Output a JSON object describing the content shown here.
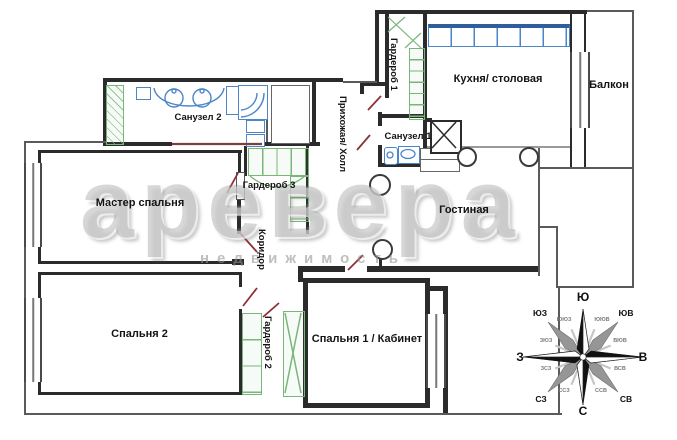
{
  "rooms": {
    "sanuzel2": {
      "label": "Санузел 2"
    },
    "garderob3": {
      "label": "Гардероб 3"
    },
    "master": {
      "label": "Мастер спальня"
    },
    "bedroom2": {
      "label": "Спальня 2"
    },
    "garderob2": {
      "label": "Гардероб 2"
    },
    "bedroom1": {
      "label": "Спальня 1 / Кабинет"
    },
    "corridor": {
      "label": "Коридор"
    },
    "hall": {
      "label": "Прихожая/ Холл"
    },
    "garderob1": {
      "label": "Гардероб 1"
    },
    "kitchen": {
      "label": "Кухня/ столовая"
    },
    "balcony": {
      "label": "Балкон"
    },
    "sanuzel1": {
      "label": "Санузел 1"
    },
    "living": {
      "label": "Гостиная"
    }
  },
  "watermark": {
    "brand": "аревера",
    "subtitle": "недвижимость"
  },
  "compass": {
    "top": "Ю",
    "bottom": "С",
    "left": "З",
    "right": "В",
    "top_left": "ЮЗ",
    "top_right": "ЮВ",
    "bottom_left": "СЗ",
    "bottom_right": "СВ",
    "minor": [
      "ЮЮЗ",
      "ЮЮВ",
      "ЗЮЗ",
      "ВЮВ",
      "ЗСЗ",
      "ВСВ",
      "ССЗ",
      "ССВ"
    ]
  },
  "colors": {
    "wall": "#2b2b2b",
    "fixtures_blue": "#4b86c8",
    "wardrobe_green": "#7ab57a",
    "door_swing_red": "#8e3038",
    "watermark_gray": "#9a9a9a"
  }
}
